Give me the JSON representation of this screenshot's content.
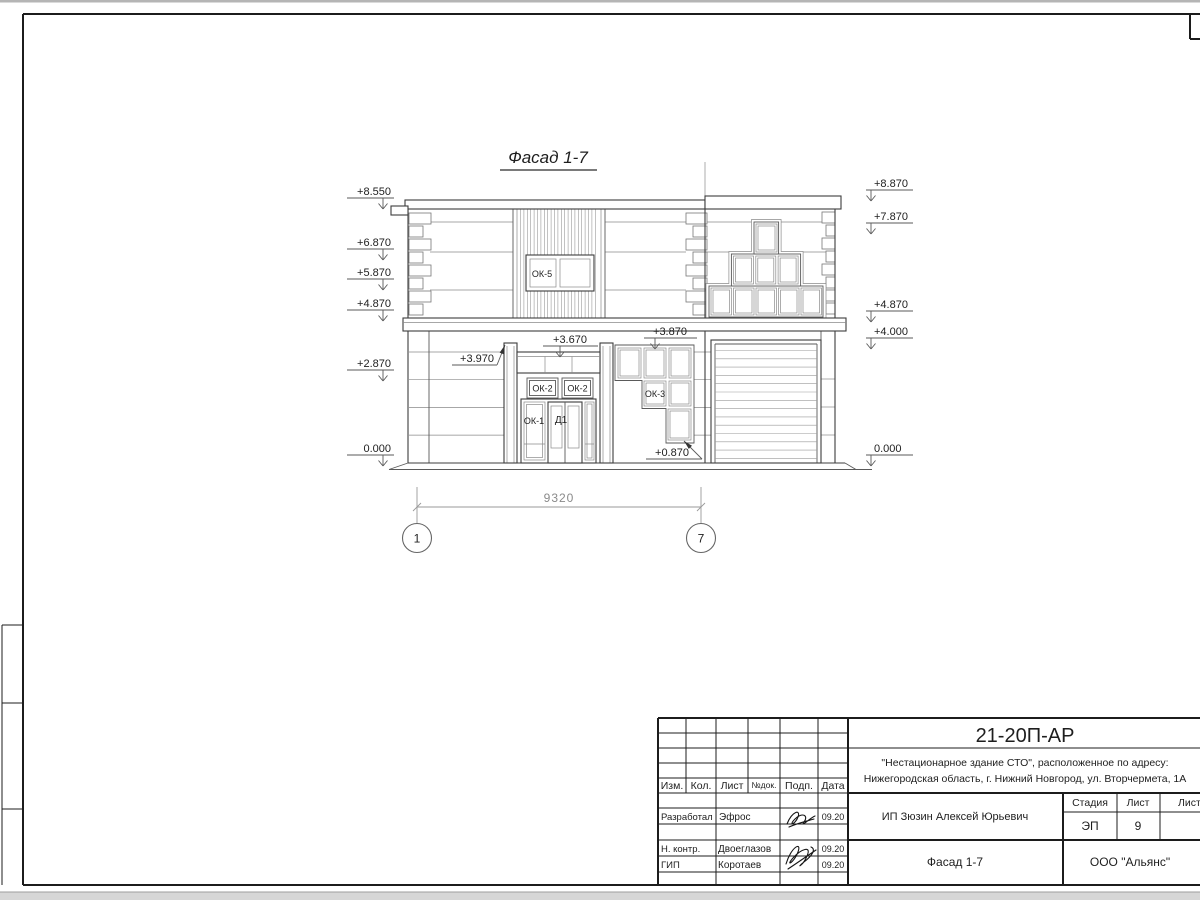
{
  "facade": {
    "title": "Фасад 1-7",
    "marks_left": [
      "+8.550",
      "+6.870",
      "+5.870",
      "+4.870",
      "+2.870",
      "0.000"
    ],
    "marks_right": [
      "+8.870",
      "+7.870",
      "+4.870",
      "+4.000",
      "0.000"
    ],
    "callouts": {
      "pilaster_top": "+3.970",
      "lintel_top": "+3.670",
      "ok3_top": "+3.870",
      "ok3_bottom": "+0.870"
    },
    "labels": {
      "ok5": "ОК-5",
      "ok2_left": "ОК-2",
      "ok2_right": "ОК-2",
      "ok1": "ОК-1",
      "d1": "Д1",
      "ok3": "ОК-3"
    },
    "dimension_width": "9320",
    "axes": [
      "1",
      "7"
    ]
  },
  "titleblock": {
    "doc_number": "21-20П-АР",
    "address_line1": "\"Нестационарное здание СТО\", расположенное по адресу:",
    "address_line2": "Нижегородская область, г. Нижний Новгород, ул. Вторчермета, 1А",
    "header": {
      "izm": "Изм.",
      "kol": "Кол.",
      "list": "Лист",
      "ndok": "№док.",
      "podp": "Подп.",
      "data": "Дата"
    },
    "persons": [
      {
        "role": "Разработал",
        "name": "Эфрос",
        "date": "09.20"
      },
      {
        "role": "Н. контр.",
        "name": "Двоеглазов",
        "date": "09.20"
      },
      {
        "role": "ГИП",
        "name": "Коротаев",
        "date": "09.20"
      }
    ],
    "client": "ИП Зюзин Алексей Юрьевич",
    "stage_label": "Стадия",
    "sheet_label": "Лист",
    "sheets_label": "Листов",
    "stage_value": "ЭП",
    "sheet_value": "9",
    "object_title": "Фасад 1-7",
    "company": "ООО \"Альянс\""
  }
}
